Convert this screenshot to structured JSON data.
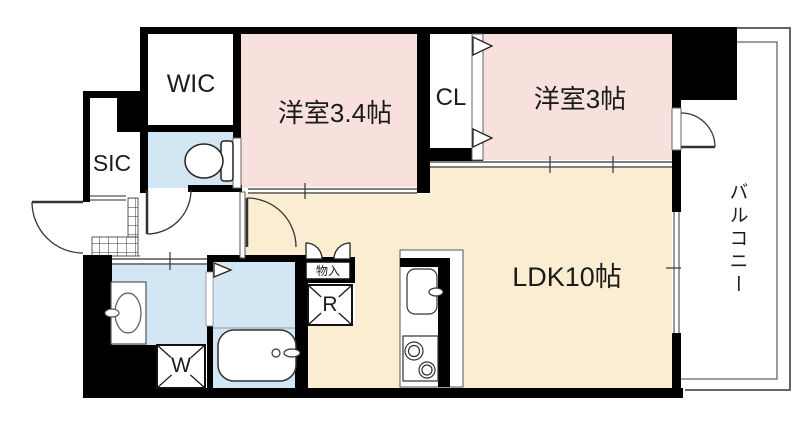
{
  "rooms": {
    "wic": "WIC",
    "sic": "SIC",
    "closet": "CL",
    "western_room_large": "洋室3.4帖",
    "western_room_small": "洋室3帖",
    "ldk": "LDK10帖",
    "balcony": "バルコニー",
    "storage": "物入",
    "refrigerator_space": "R",
    "washer_space": "W"
  },
  "colors": {
    "wall": "#000000",
    "western_room_fill": "#f8e0dc",
    "ldk_fill": "#fbedd2",
    "wet_area_fill": "#d3e6f3",
    "fixture_line": "#333333",
    "balcony_line": "#666666"
  }
}
